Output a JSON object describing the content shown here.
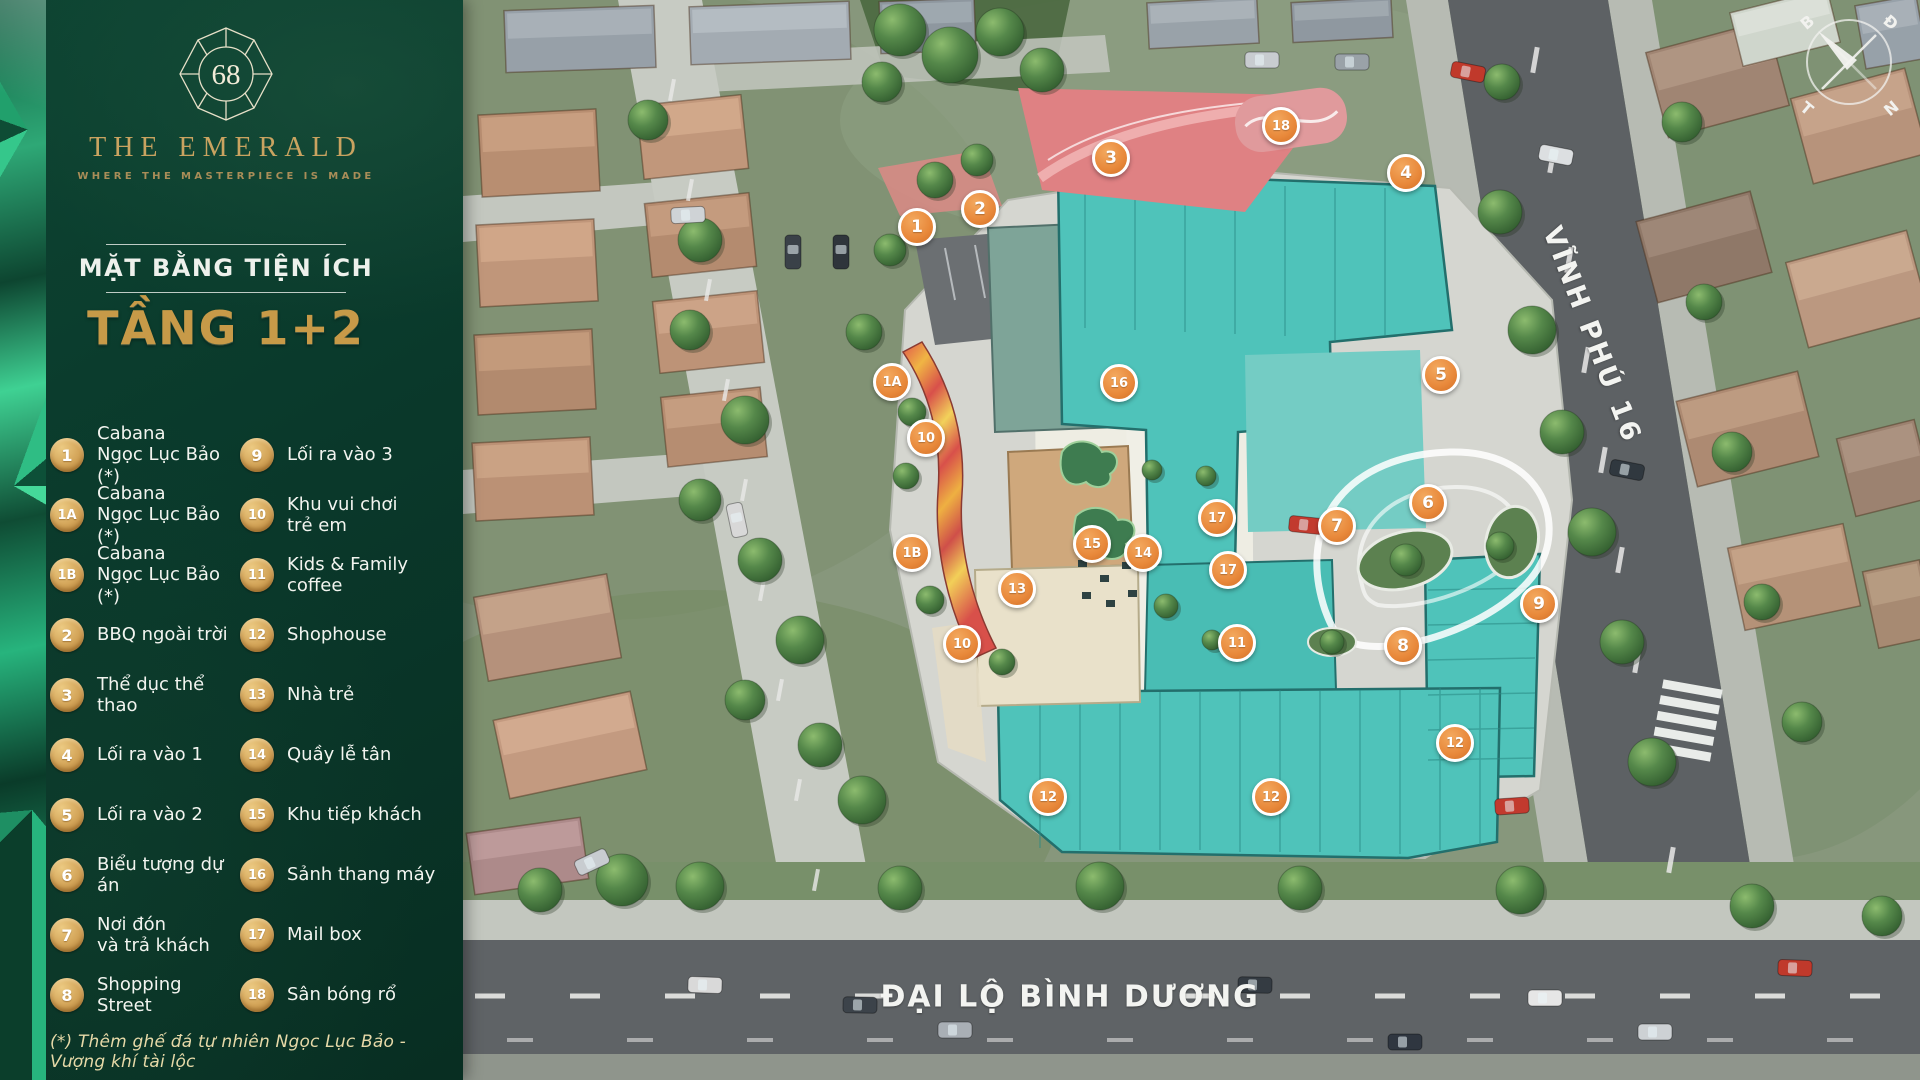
{
  "brand": {
    "logo_number": "68",
    "name": "THE EMERALD",
    "tagline": "WHERE THE MASTERPIECE IS MADE"
  },
  "plan": {
    "subtitle": "MẶT BẰNG TIỆN ÍCH",
    "title": "TẦNG 1+2"
  },
  "legend": {
    "col1": [
      {
        "id": "1",
        "label": "Cabana\nNgọc Lục Bảo (*)"
      },
      {
        "id": "1A",
        "label": "Cabana\nNgọc Lục Bảo (*)"
      },
      {
        "id": "1B",
        "label": "Cabana\nNgọc Lục Bảo (*)"
      },
      {
        "id": "2",
        "label": "BBQ ngoài trời"
      },
      {
        "id": "3",
        "label": "Thể dục thể thao"
      },
      {
        "id": "4",
        "label": "Lối ra vào 1"
      },
      {
        "id": "5",
        "label": "Lối ra vào 2"
      },
      {
        "id": "6",
        "label": "Biểu tượng dự án"
      },
      {
        "id": "7",
        "label": "Nơi đón\nvà trả khách"
      },
      {
        "id": "8",
        "label": "Shopping Street"
      }
    ],
    "col2": [
      {
        "id": "9",
        "label": "Lối ra vào 3"
      },
      {
        "id": "10",
        "label": "Khu vui chơi\ntrẻ em"
      },
      {
        "id": "11",
        "label": "Kids & Family coffee"
      },
      {
        "id": "12",
        "label": "Shophouse"
      },
      {
        "id": "13",
        "label": "Nhà trẻ"
      },
      {
        "id": "14",
        "label": "Quầy lễ tân"
      },
      {
        "id": "15",
        "label": "Khu tiếp khách"
      },
      {
        "id": "16",
        "label": "Sảnh thang máy"
      },
      {
        "id": "17",
        "label": "Mail box"
      },
      {
        "id": "18",
        "label": "Sân bóng rổ"
      }
    ]
  },
  "footnote": "(*) Thêm ghế đá tự nhiên Ngọc Lục Bảo - Vượng khí tài lộc",
  "map": {
    "road_labels": {
      "vinh_phu": "VĨNH PHÚ 16",
      "boulevard": "ĐẠI LỘ BÌNH DƯƠNG"
    },
    "compass": {
      "b": "B",
      "d": "Đ",
      "t": "T",
      "n": "N"
    },
    "markers": [
      {
        "id": "1",
        "x": 917,
        "y": 227
      },
      {
        "id": "2",
        "x": 980,
        "y": 209
      },
      {
        "id": "3",
        "x": 1111,
        "y": 158
      },
      {
        "id": "18",
        "x": 1281,
        "y": 126
      },
      {
        "id": "4",
        "x": 1406,
        "y": 173
      },
      {
        "id": "1A",
        "x": 892,
        "y": 382
      },
      {
        "id": "16",
        "x": 1119,
        "y": 383
      },
      {
        "id": "5",
        "x": 1441,
        "y": 375
      },
      {
        "id": "10",
        "x": 926,
        "y": 438
      },
      {
        "id": "6",
        "x": 1428,
        "y": 503
      },
      {
        "id": "17",
        "x": 1217,
        "y": 518
      },
      {
        "id": "7",
        "x": 1337,
        "y": 526
      },
      {
        "id": "15",
        "x": 1092,
        "y": 544
      },
      {
        "id": "14",
        "x": 1143,
        "y": 553
      },
      {
        "id": "1B",
        "x": 912,
        "y": 553
      },
      {
        "id": "17",
        "x": 1228,
        "y": 570
      },
      {
        "id": "13",
        "x": 1017,
        "y": 589
      },
      {
        "id": "9",
        "x": 1539,
        "y": 604
      },
      {
        "id": "10",
        "x": 962,
        "y": 644
      },
      {
        "id": "11",
        "x": 1237,
        "y": 643
      },
      {
        "id": "8",
        "x": 1403,
        "y": 646
      },
      {
        "id": "12",
        "x": 1455,
        "y": 743
      },
      {
        "id": "12",
        "x": 1048,
        "y": 797
      },
      {
        "id": "12",
        "x": 1271,
        "y": 797
      }
    ]
  },
  "colors": {
    "sidebar_green": "#0A392B",
    "accent_gold": "#C9A360",
    "badge_gold": "#D3A458",
    "marker_orange": "#E8883A",
    "building_teal": "#4FC3BA",
    "road_dark": "#5D6164"
  }
}
